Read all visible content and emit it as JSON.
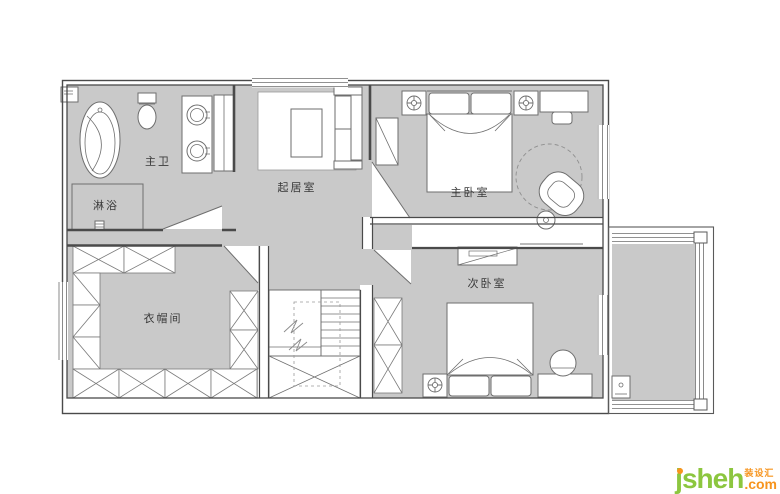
{
  "rooms": {
    "master_bath": "主卫",
    "shower": "淋浴",
    "living": "起居室",
    "master_bedroom": "主卧室",
    "closet": "衣帽间",
    "second_bedroom": "次卧室"
  },
  "watermark": {
    "brand": "jsheh",
    "tagline": "装设汇",
    "tld": ".com"
  },
  "colors": {
    "floor_gray": "#c9c9c9",
    "wall": "#4a4a4a",
    "furniture_stroke": "#6e6e6e",
    "brand_green": "#8cc63f",
    "brand_orange": "#f7941d"
  }
}
